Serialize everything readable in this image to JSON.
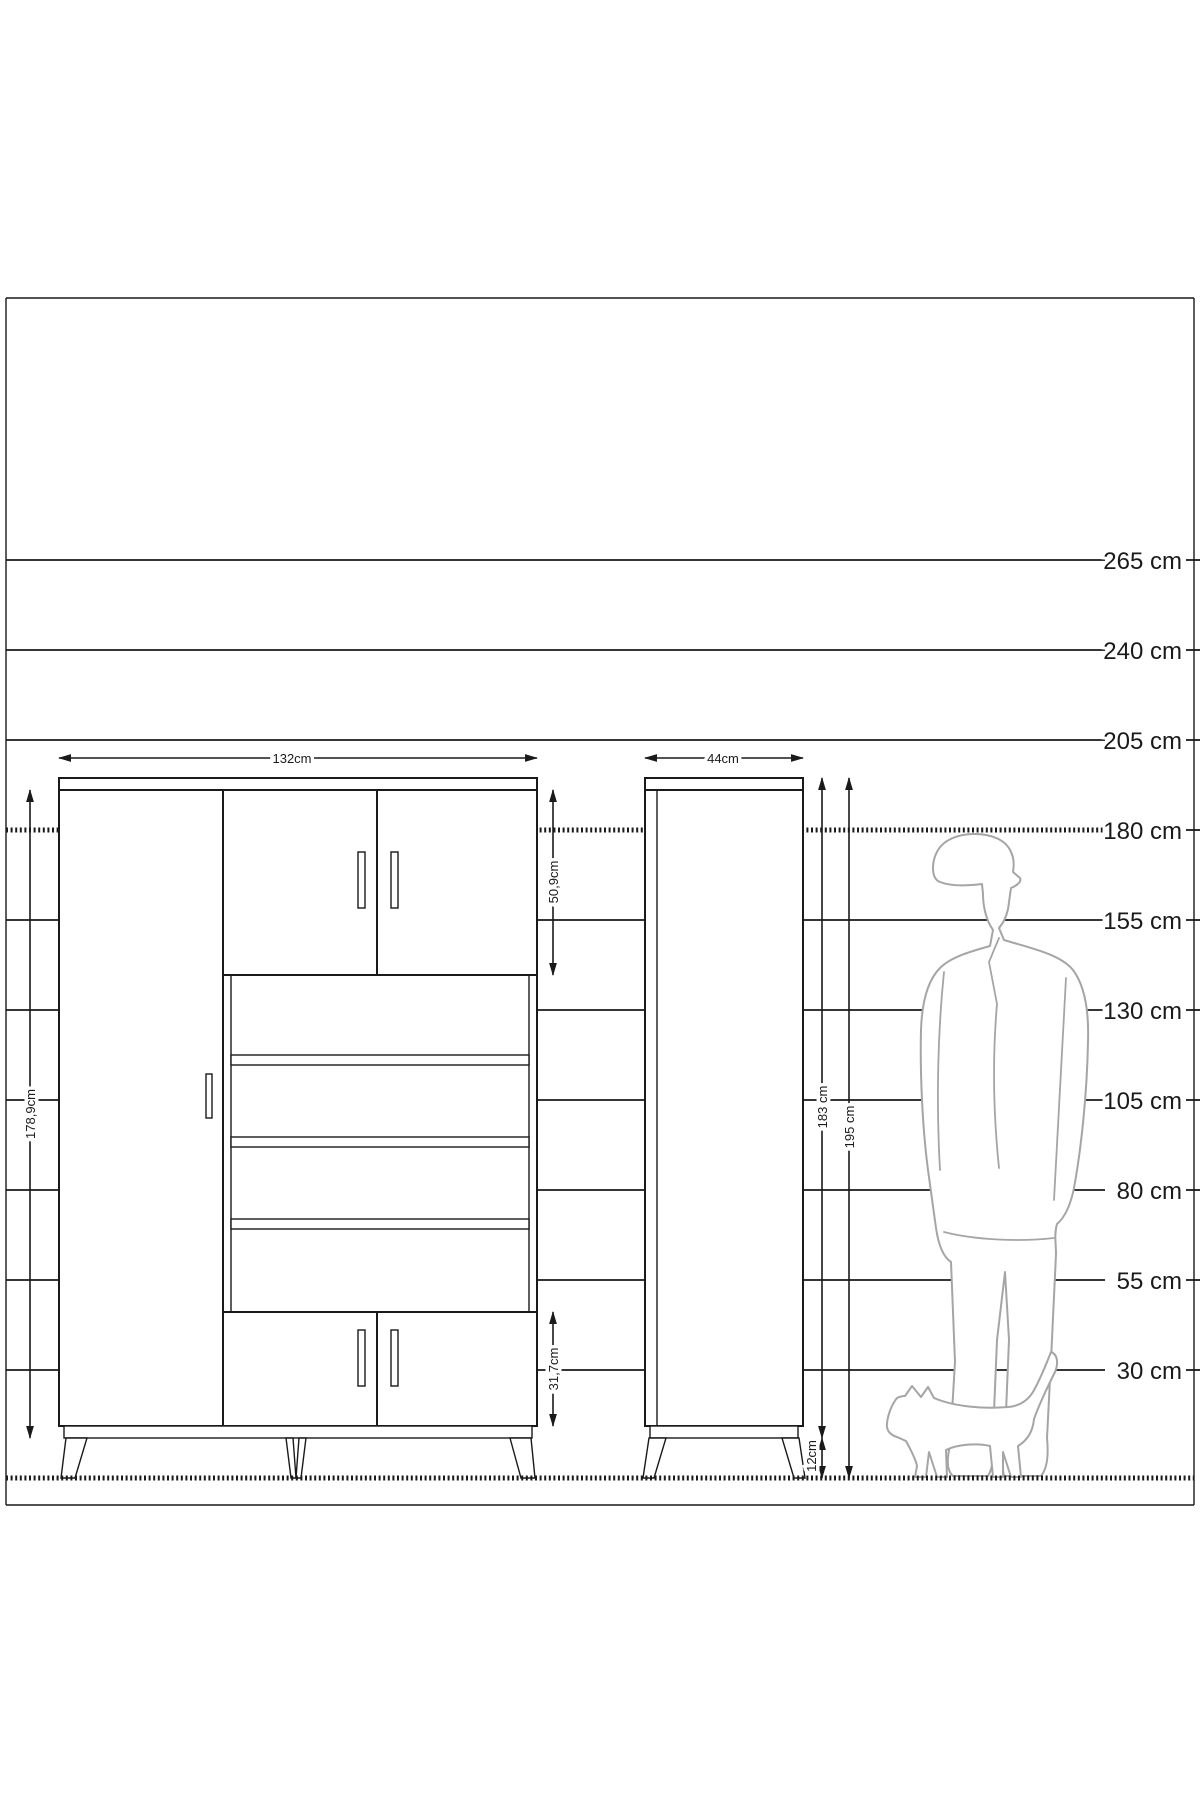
{
  "title": "furniture-dimension-diagram",
  "ruler": {
    "unit": "cm",
    "lines": [
      {
        "label": "265 cm",
        "style": "solid"
      },
      {
        "label": "240 cm",
        "style": "solid"
      },
      {
        "label": "205 cm",
        "style": "solid"
      },
      {
        "label": "180 cm",
        "style": "hatched"
      },
      {
        "label": "155 cm",
        "style": "solid"
      },
      {
        "label": "130 cm",
        "style": "solid"
      },
      {
        "label": "105 cm",
        "style": "solid"
      },
      {
        "label": "80 cm",
        "style": "solid"
      },
      {
        "label": "55 cm",
        "style": "solid"
      },
      {
        "label": "30 cm",
        "style": "solid"
      }
    ]
  },
  "front_view": {
    "width_label": "132cm",
    "height_label": "178,9cm",
    "top_doors_height_label": "50,9cm",
    "bottom_doors_height_label": "31,7cm"
  },
  "side_view": {
    "depth_label": "44cm",
    "body_height_label": "183 cm",
    "total_height_label": "195 cm",
    "leg_height_label": "12cm"
  },
  "figures": {
    "person": "man-silhouette-for-scale",
    "cat": "cat-silhouette-for-scale"
  },
  "colors": {
    "line": "#1a1a1a",
    "silhouette": "#a5a5a5",
    "background": "#ffffff"
  }
}
